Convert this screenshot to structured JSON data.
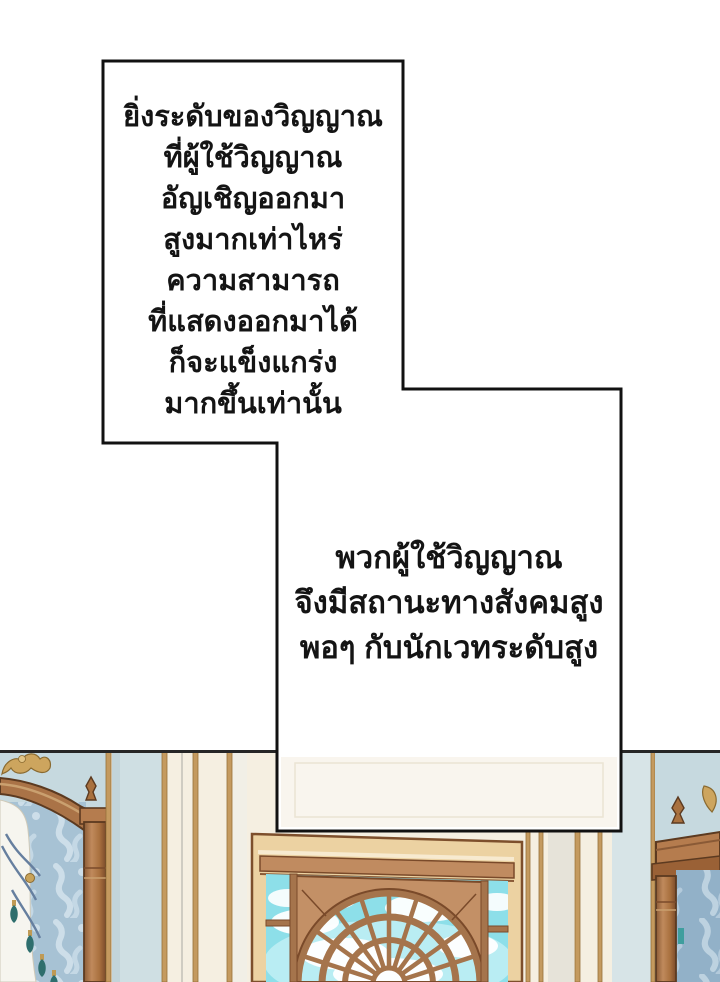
{
  "page": {
    "kind": "webtoon comic page",
    "background": "#ffffff"
  },
  "narration_box_1": {
    "lines": [
      "ยิ่งระดับของวิญญาณ",
      "ที่ผู้ใช้วิญญาณ",
      "อัญเชิญออกมา",
      "สูงมากเท่าไหร่",
      "ความสามารถ",
      "ที่แสดงออกมาได้",
      "ก็จะแข็งแกร่ง",
      "มากขึ้นเท่านั้น"
    ]
  },
  "narration_box_2": {
    "lines": [
      "พวกผู้ใช้วิญญาณ",
      "จึงมีสถานะทางสังคมสูง",
      "พอๆ กับนักเวทระดับสูง"
    ]
  },
  "artwork": {
    "scene": "palace interior wall: blue damask canopy frames left and right, cream wall with gold stripe paneling, large wooden arched fan window with cyan sky and clouds",
    "colors": {
      "wall_cream": "#f5efe1",
      "panel_light_blue": "#c6d9df",
      "panel_pale_blue": "#d7e4e7",
      "stripe_gold": "#c49a5f",
      "wood_brown": "#a9713f",
      "wood_mullion": "#a5744c",
      "wood_dark_outline": "#5c3a20",
      "window_frame_tan": "#ecd2a2",
      "sky_cyan": "#8ddfe9",
      "cloud_white": "#ffffff",
      "damask_left": "#a7c2d4",
      "damask_right": "#92b1c8",
      "curtain_white": "#f6f5ef",
      "tassel_teal": "#2e6e6d",
      "crest_gold": "#cda55e",
      "panel_border_black": "#111111"
    }
  }
}
